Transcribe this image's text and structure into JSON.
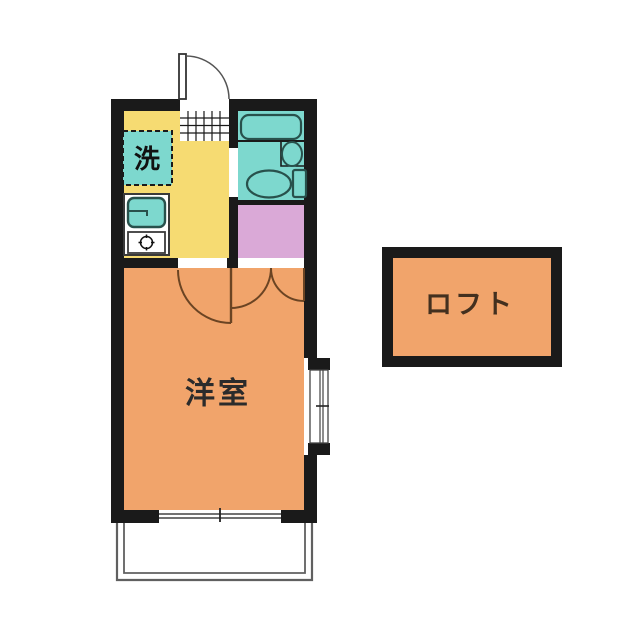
{
  "plan": {
    "type": "apartment-floor-plan",
    "rooms": {
      "western_room": {
        "label": "洋室"
      },
      "loft": {
        "label": "ロフト"
      },
      "laundry": {
        "label": "洗"
      }
    }
  },
  "colors": {
    "wall": "#1a1a1a",
    "kitchen_floor": "#f6db72",
    "bathroom": "#7dd8ce",
    "closet": "#daa9d7",
    "main_room": "#f1a46b",
    "loft": "#f1a46b",
    "door_arc": "#6b4423",
    "label_text": "#2b2b2b",
    "loft_label_text": "#43301f",
    "fixture_outline": "#28514c",
    "balcony_rail": "#606060"
  },
  "fixtures": {
    "entry_door": "hinged-door-with-swing-arc",
    "entrance_tile": "grid-tiles",
    "bathtub": "rounded-rectangle",
    "toilet": "bowl-and-tank",
    "hand_basin": "oval-basin",
    "washing_machine_space": "dashed-square",
    "kitchen_sink": "rounded-rect-with-faucet",
    "gas_stove": "burner-crosshair-icon",
    "closet_doors": "double-swing-arcs",
    "bay_window": "double-pane-window",
    "sliding_window": "double-line-window",
    "balcony": "open-railing"
  }
}
